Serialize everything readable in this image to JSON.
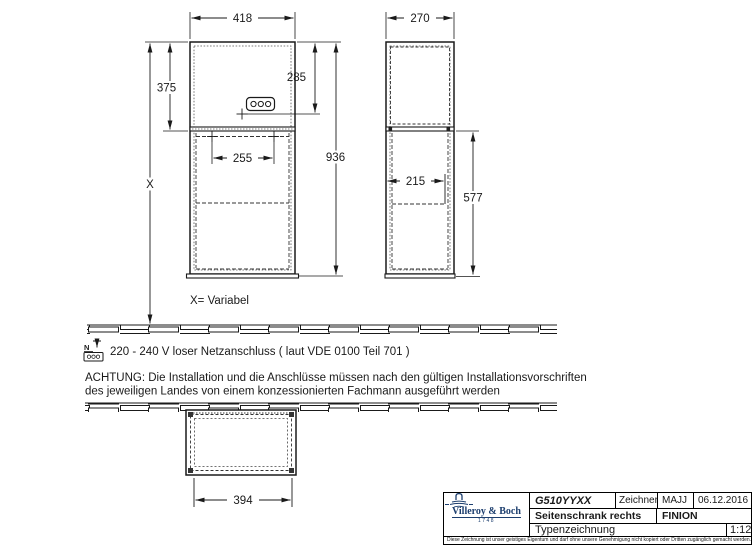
{
  "dims": {
    "front_width": "418",
    "front_upper_height": "375",
    "socket_drop": "285",
    "front_total_height": "936",
    "drill_span": "255",
    "height_variable": "X",
    "side_depth": "270",
    "side_inner_depth": "215",
    "side_lower_height": "577",
    "bottom_width": "394"
  },
  "notes": {
    "variable": "X= Variabel",
    "power_icon_letter": "N",
    "power": "220 - 240 V loser Netzanschluss ( laut VDE 0100 Teil 701 )",
    "warning1": "ACHTUNG: Die Installation und die Anschlüsse müssen nach den gültigen Installationsvorschriften",
    "warning2": "des jeweiligen Landes von einem konzessionierten Fachmann ausgeführt werden"
  },
  "title_block": {
    "article": "G510YYXX",
    "drafter_label": "Zeichner",
    "drafter": "MAJJ",
    "date": "06.12.2016",
    "product": "Seitenschrank rechts",
    "series": "FINION",
    "type": "Typenzeichnung",
    "scale": "1:12",
    "brand": "Villeroy & Boch",
    "year": "1748",
    "copyright": "Diese Zeichnung ist unser geistiges Eigentum und darf ohne unsere Genehmigung nicht kopiert oder Dritten zugänglich gemacht werden."
  },
  "colors": {
    "line": "#1a1a1a",
    "brand_blue": "#1c3e6e",
    "background": "#ffffff"
  }
}
